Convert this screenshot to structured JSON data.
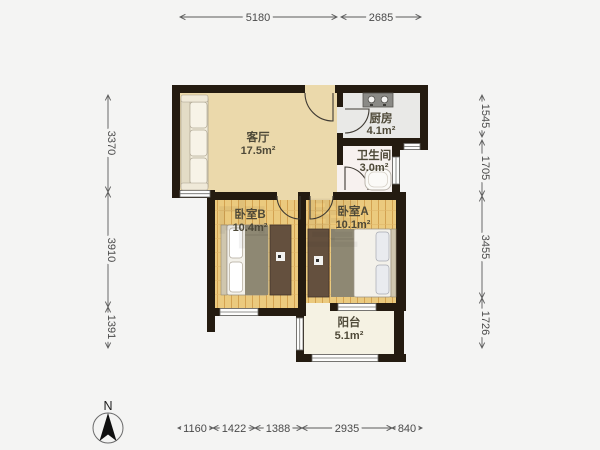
{
  "floor_plan": {
    "rooms": [
      {
        "id": "living",
        "name": "客厅",
        "area": "17.5m²"
      },
      {
        "id": "kitchen",
        "name": "厨房",
        "area": "4.1m²"
      },
      {
        "id": "bathroom",
        "name": "卫生间",
        "area": "3.0m²"
      },
      {
        "id": "bedroom_b",
        "name": "卧室B",
        "area": "10.4m²"
      },
      {
        "id": "bedroom_a",
        "name": "卧室A",
        "area": "10.1m²"
      },
      {
        "id": "balcony",
        "name": "阳台",
        "area": "5.1m²"
      }
    ],
    "dimensions_mm": {
      "top": [
        "5180",
        "2685"
      ],
      "left": [
        "3370",
        "3910",
        "1391"
      ],
      "right": [
        "1545",
        "1705",
        "3455",
        "1726"
      ],
      "bottom": [
        "1160",
        "1422",
        "1388",
        "2935",
        "840"
      ]
    },
    "compass": {
      "label": "N"
    },
    "watermark": "中壁",
    "colors": {
      "background": "#f4f4f3",
      "wall": "#241b10",
      "living_floor": "#ebd9ab",
      "wood_floor": "#ebca7e",
      "kitchen_floor": "#e9e9e7",
      "bathroom_floor": "#f7f1ef",
      "balcony_floor": "#f5f2e3",
      "dimension_text": "#4a4a4a"
    }
  }
}
